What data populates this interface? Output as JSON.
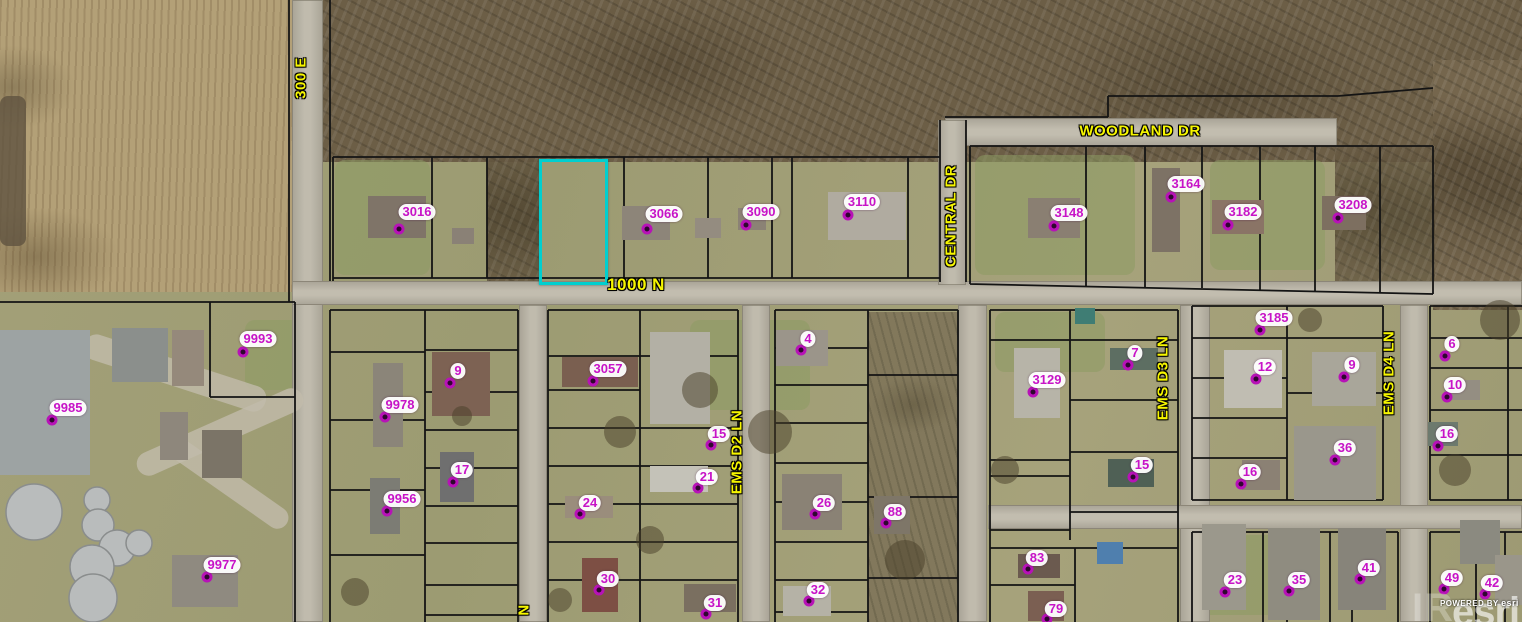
{
  "map": {
    "type": "parcel-aerial-map",
    "colors": {
      "road_label": "#F6F600",
      "parcel_label": "#C713C7",
      "parcel_line": "#141414",
      "selection_highlight": "#00CFCF"
    },
    "roads": [
      {
        "name": "300 E",
        "orientation": "vertical",
        "x": 301,
        "y": 78
      },
      {
        "name": "WOODLAND DR",
        "orientation": "horizontal",
        "x": 1140,
        "y": 131
      },
      {
        "name": "CENTRAL DR",
        "orientation": "vertical",
        "x": 951,
        "y": 216
      },
      {
        "name": "1000 N",
        "orientation": "horizontal",
        "x": 636,
        "y": 285,
        "big": true
      },
      {
        "name": "EMS D2 LN",
        "orientation": "vertical",
        "x": 737,
        "y": 452
      },
      {
        "name": "EMS D3 LN",
        "orientation": "vertical",
        "x": 1163,
        "y": 378
      },
      {
        "name": "EMS D4 LN",
        "orientation": "vertical",
        "x": 1389,
        "y": 373
      },
      {
        "name": "N",
        "orientation": "vertical",
        "x": 524,
        "y": 610,
        "partial": true
      }
    ],
    "parcels": [
      {
        "id": "3016",
        "x": 417,
        "y": 212,
        "dot": [
          399,
          229
        ]
      },
      {
        "id": "3066",
        "x": 664,
        "y": 214,
        "dot": [
          647,
          229
        ]
      },
      {
        "id": "3090",
        "x": 761,
        "y": 212,
        "dot": [
          746,
          225
        ]
      },
      {
        "id": "3110",
        "x": 862,
        "y": 202,
        "dot": [
          848,
          215
        ]
      },
      {
        "id": "3148",
        "x": 1069,
        "y": 213,
        "dot": [
          1054,
          226
        ]
      },
      {
        "id": "3164",
        "x": 1186,
        "y": 184,
        "dot": [
          1171,
          197
        ]
      },
      {
        "id": "3182",
        "x": 1243,
        "y": 212,
        "dot": [
          1228,
          225
        ]
      },
      {
        "id": "3208",
        "x": 1353,
        "y": 205,
        "dot": [
          1338,
          218
        ]
      },
      {
        "id": "9993",
        "x": 258,
        "y": 339,
        "dot": [
          243,
          352
        ]
      },
      {
        "id": "9985",
        "x": 68,
        "y": 408,
        "dot": [
          52,
          420
        ]
      },
      {
        "id": "9977",
        "x": 222,
        "y": 565,
        "dot": [
          207,
          577
        ]
      },
      {
        "id": "9978",
        "x": 400,
        "y": 405,
        "dot": [
          385,
          417
        ]
      },
      {
        "id": "9",
        "x": 458,
        "y": 371,
        "dot": [
          450,
          383
        ]
      },
      {
        "id": "3057",
        "x": 608,
        "y": 369,
        "dot": [
          593,
          381
        ]
      },
      {
        "id": "17",
        "x": 462,
        "y": 470,
        "dot": [
          453,
          482
        ]
      },
      {
        "id": "9956",
        "x": 402,
        "y": 499,
        "dot": [
          387,
          511
        ]
      },
      {
        "id": "24",
        "x": 590,
        "y": 503,
        "dot": [
          580,
          514
        ]
      },
      {
        "id": "30",
        "x": 608,
        "y": 579,
        "dot": [
          599,
          590
        ]
      },
      {
        "id": "31",
        "x": 715,
        "y": 603,
        "dot": [
          706,
          614
        ]
      },
      {
        "id": "15",
        "x": 719,
        "y": 434,
        "dot": [
          711,
          445
        ]
      },
      {
        "id": "21",
        "x": 707,
        "y": 477,
        "dot": [
          698,
          488
        ]
      },
      {
        "id": "4",
        "x": 808,
        "y": 339,
        "dot": [
          801,
          350
        ]
      },
      {
        "id": "26",
        "x": 824,
        "y": 503,
        "dot": [
          815,
          514
        ]
      },
      {
        "id": "88",
        "x": 895,
        "y": 512,
        "dot": [
          886,
          523
        ]
      },
      {
        "id": "32",
        "x": 818,
        "y": 590,
        "dot": [
          809,
          601
        ]
      },
      {
        "id": "3129",
        "x": 1047,
        "y": 380,
        "dot": [
          1033,
          392
        ]
      },
      {
        "id": "7",
        "x": 1135,
        "y": 353,
        "dot": [
          1128,
          365
        ]
      },
      {
        "id": "15",
        "x": 1142,
        "y": 465,
        "dot": [
          1133,
          477
        ]
      },
      {
        "id": "83",
        "x": 1037,
        "y": 558,
        "dot": [
          1028,
          569
        ]
      },
      {
        "id": "79",
        "x": 1056,
        "y": 609,
        "dot": [
          1047,
          619
        ]
      },
      {
        "id": "3185",
        "x": 1274,
        "y": 318,
        "dot": [
          1260,
          330
        ]
      },
      {
        "id": "12",
        "x": 1265,
        "y": 367,
        "dot": [
          1256,
          379
        ]
      },
      {
        "id": "9",
        "x": 1352,
        "y": 365,
        "dot": [
          1344,
          377
        ]
      },
      {
        "id": "36",
        "x": 1345,
        "y": 448,
        "dot": [
          1335,
          460
        ]
      },
      {
        "id": "16",
        "x": 1250,
        "y": 472,
        "dot": [
          1241,
          484
        ]
      },
      {
        "id": "23",
        "x": 1235,
        "y": 580,
        "dot": [
          1225,
          592
        ]
      },
      {
        "id": "35",
        "x": 1299,
        "y": 580,
        "dot": [
          1289,
          591
        ]
      },
      {
        "id": "41",
        "x": 1369,
        "y": 568,
        "dot": [
          1360,
          579
        ]
      },
      {
        "id": "6",
        "x": 1452,
        "y": 344,
        "dot": [
          1445,
          356
        ]
      },
      {
        "id": "10",
        "x": 1455,
        "y": 385,
        "dot": [
          1447,
          397
        ]
      },
      {
        "id": "16",
        "x": 1447,
        "y": 434,
        "dot": [
          1438,
          446
        ]
      },
      {
        "id": "49",
        "x": 1452,
        "y": 578,
        "dot": [
          1444,
          589
        ]
      },
      {
        "id": "42",
        "x": 1492,
        "y": 583,
        "dot": [
          1485,
          594
        ]
      }
    ],
    "selected_parcel": {
      "x": 539,
      "y": 159,
      "width": 63,
      "height": 120
    },
    "attribution": {
      "powered_by": "POWERED BY",
      "brand": "esri",
      "watermark": "esri",
      "watermark_partial": "IR"
    }
  }
}
